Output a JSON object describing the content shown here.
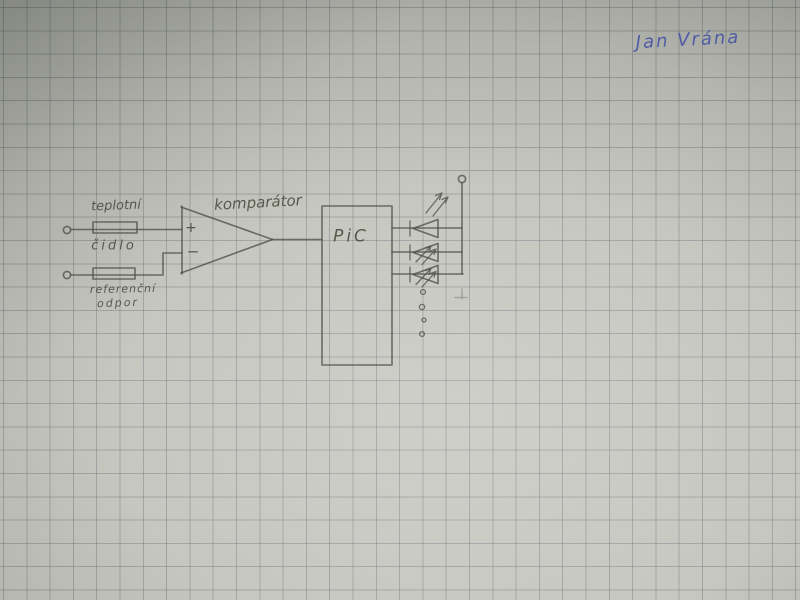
{
  "paper": {
    "kind": "squared-graph-paper-photo",
    "base_color": "#c3c5bd",
    "grid_color": "#696e72",
    "grid_spacing_px": 23.3
  },
  "signature": {
    "text": "Jan Vrána",
    "ink_color": "#4653a6"
  },
  "schematic": {
    "pencil_color": "#4f4f49",
    "labels": {
      "sensor_line1": "teplotní",
      "sensor_line2": "čidlo",
      "reference_line1": "referenční",
      "reference_line2": "odpor",
      "comparator": "komparátor",
      "comparator_plus": "+",
      "comparator_minus": "−",
      "mcu": "PiC"
    },
    "components": [
      "input-terminal-top",
      "input-terminal-bottom",
      "temperature-sensor-resistor",
      "reference-resistor",
      "comparator-opamp",
      "pic-microcontroller",
      "led-1",
      "led-2",
      "led-3",
      "supply-rail-terminal",
      "more-outputs-ellipsis-dots"
    ]
  }
}
